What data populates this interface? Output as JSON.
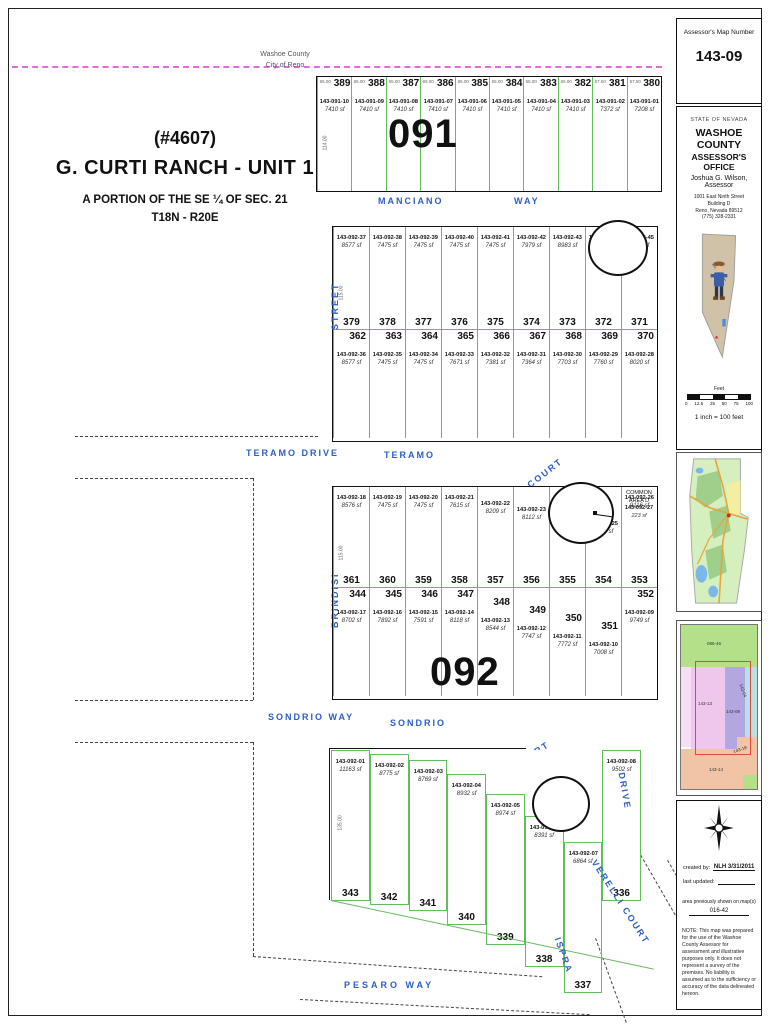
{
  "map": {
    "boundary": {
      "line1": "Washoe County",
      "line2": "City of Reno"
    },
    "title": {
      "permit": "(#4607)",
      "name": "G. CURTI RANCH - UNIT 1",
      "portion": "A PORTION OF THE SE ¼ OF SEC. 21",
      "township": "T18N - R20E"
    },
    "block_numbers": {
      "north": "091",
      "south": "092"
    },
    "streets": {
      "manciano": "MANCIANO",
      "manciano_suffix": "WAY",
      "teramo_drive": "TERAMO  DRIVE",
      "teramo": "TERAMO",
      "teramo_suffix": "COURT",
      "street_word": "STREET",
      "brindisi": "BRINDISI",
      "sondrio_way": "SONDRIO  WAY",
      "sondrio": "SONDRIO",
      "sondrio_suffix": "COURT",
      "pesaro": "PESARO   WAY",
      "verelli": "VERELLI  COURT",
      "ispra": "ISPRA",
      "drive": "DRIVE"
    },
    "common_area": {
      "line1": "COMMON",
      "line2": "AREA D",
      "apn": "143-092-27",
      "area": "223 sf"
    },
    "blocks": {
      "b091": {
        "side_dim": "114.00",
        "parcels": [
          {
            "lot": "389",
            "apn": "143-091-10",
            "area": "7410 sf",
            "dim": "65.00"
          },
          {
            "lot": "388",
            "apn": "143-091-09",
            "area": "7410 sf",
            "dim": "65.00"
          },
          {
            "lot": "387",
            "apn": "143-091-08",
            "area": "7410 sf",
            "dim": "65.00"
          },
          {
            "lot": "386",
            "apn": "143-091-07",
            "area": "7410 sf",
            "dim": "65.00"
          },
          {
            "lot": "385",
            "apn": "143-091-06",
            "area": "7410 sf",
            "dim": "65.00"
          },
          {
            "lot": "384",
            "apn": "143-091-05",
            "area": "7410 sf",
            "dim": "65.00"
          },
          {
            "lot": "383",
            "apn": "143-091-04",
            "area": "7410 sf",
            "dim": "65.00"
          },
          {
            "lot": "382",
            "apn": "143-091-03",
            "area": "7410 sf",
            "dim": "65.00"
          },
          {
            "lot": "381",
            "apn": "143-091-02",
            "area": "7372 sf",
            "dim": "67.50"
          },
          {
            "lot": "380",
            "apn": "143-091-01",
            "area": "7208 sf",
            "dim": "67.50"
          }
        ]
      },
      "b092a_top": {
        "side_dim": "115.00",
        "parcels": [
          {
            "lot": "379",
            "apn": "143-092-37",
            "area": "8577 sf"
          },
          {
            "lot": "378",
            "apn": "143-092-38",
            "area": "7475 sf"
          },
          {
            "lot": "377",
            "apn": "143-092-39",
            "area": "7475 sf"
          },
          {
            "lot": "376",
            "apn": "143-092-40",
            "area": "7475 sf"
          },
          {
            "lot": "375",
            "apn": "143-092-41",
            "area": "7475 sf"
          },
          {
            "lot": "374",
            "apn": "143-092-42",
            "area": "7979 sf"
          },
          {
            "lot": "373",
            "apn": "143-092-43",
            "area": "8983 sf"
          },
          {
            "lot": "372",
            "apn": "143-092-44",
            "area": "7107 sf"
          },
          {
            "lot": "371",
            "apn": "143-092-45",
            "area": "7067 sf"
          }
        ]
      },
      "b092a_bottom": {
        "side_dim": "115.00",
        "parcels": [
          {
            "lot": "362",
            "apn": "143-092-36",
            "area": "8577 sf"
          },
          {
            "lot": "363",
            "apn": "143-092-35",
            "area": "7475 sf"
          },
          {
            "lot": "364",
            "apn": "143-092-34",
            "area": "7475 sf"
          },
          {
            "lot": "365",
            "apn": "143-092-33",
            "area": "7671 sf"
          },
          {
            "lot": "366",
            "apn": "143-092-32",
            "area": "7381 sf"
          },
          {
            "lot": "367",
            "apn": "143-092-31",
            "area": "7364 sf"
          },
          {
            "lot": "368",
            "apn": "143-092-30",
            "area": "7703 sf"
          },
          {
            "lot": "369",
            "apn": "143-092-29",
            "area": "7760 sf"
          },
          {
            "lot": "370",
            "apn": "143-092-28",
            "area": "8020 sf"
          }
        ]
      },
      "b092b_top": {
        "side_dim": "115.00",
        "parcels": [
          {
            "lot": "361",
            "apn": "143-092-18",
            "area": "8576 sf"
          },
          {
            "lot": "360",
            "apn": "143-092-19",
            "area": "7475 sf"
          },
          {
            "lot": "359",
            "apn": "143-092-20",
            "area": "7475 sf"
          },
          {
            "lot": "358",
            "apn": "143-092-21",
            "area": "7615 sf"
          },
          {
            "lot": "357",
            "apn": "143-092-22",
            "area": "8209 sf"
          },
          {
            "lot": "356",
            "apn": "143-092-23",
            "area": "8112 sf"
          },
          {
            "lot": "355",
            "apn": "143-092-24",
            "area": "8225 sf"
          },
          {
            "lot": "354",
            "apn": "143-092-25",
            "area": "7050 sf"
          },
          {
            "lot": "353",
            "apn": "143-092-26",
            "area": "9116 sf"
          }
        ]
      },
      "b092b_bottom": {
        "side_dim": "135.00",
        "parcels": [
          {
            "lot": "344",
            "apn": "143-092-17",
            "area": "8702 sf"
          },
          {
            "lot": "345",
            "apn": "143-092-16",
            "area": "7892 sf"
          },
          {
            "lot": "346",
            "apn": "143-092-15",
            "area": "7591 sf"
          },
          {
            "lot": "347",
            "apn": "143-092-14",
            "area": "8118 sf"
          },
          {
            "lot": "348",
            "apn": "143-092-13",
            "area": "8544 sf"
          },
          {
            "lot": "349",
            "apn": "143-092-12",
            "area": "7747 sf"
          },
          {
            "lot": "350",
            "apn": "143-092-11",
            "area": "7772 sf"
          },
          {
            "lot": "351",
            "apn": "143-092-10",
            "area": "7008 sf"
          },
          {
            "lot": "352",
            "apn": "143-092-09",
            "area": "9749 sf"
          }
        ]
      },
      "b092c": {
        "side_dim": "135.00",
        "parcels": [
          {
            "lot": "343",
            "apn": "143-092-01",
            "area": "11163 sf"
          },
          {
            "lot": "342",
            "apn": "143-092-02",
            "area": "8775 sf"
          },
          {
            "lot": "341",
            "apn": "143-092-03",
            "area": "8769 sf"
          },
          {
            "lot": "340",
            "apn": "143-092-04",
            "area": "8932 sf"
          },
          {
            "lot": "339",
            "apn": "143-092-05",
            "area": "8974 sf"
          },
          {
            "lot": "338",
            "apn": "143-092-06",
            "area": "8391 sf"
          },
          {
            "lot": "337",
            "apn": "143-092-07",
            "area": "6864 sf"
          },
          {
            "lot": "336",
            "apn": "143-092-08",
            "area": "9502 sf"
          }
        ]
      }
    }
  },
  "sidebar": {
    "map_number_label": "Assessor's Map Number",
    "map_number": "143-09",
    "state": "STATE OF NEVADA",
    "county": "WASHOE COUNTY",
    "office": "ASSESSOR'S OFFICE",
    "assessor": "Joshua G. Wilson, Assessor",
    "address": [
      "1001 East Ninth Street",
      "Building D",
      "Reno, Nevada 89512",
      "(775) 328-2331"
    ],
    "scale_feet": "Feet",
    "scale_ticks": [
      "0",
      "12.5",
      "25",
      "50",
      "75",
      "100"
    ],
    "scale_note": "1 inch = 100 feet",
    "index": {
      "top": "086-46",
      "left": "143-13",
      "center": "143-09",
      "right": "143-04",
      "bottom_left": "143-14",
      "bottom_right": "143-18"
    },
    "created_by_label": "created by:",
    "created_by_value": "NLH 3/31/2011",
    "last_updated_label": "last updated:",
    "prev_maps_label": "area previously shown on map(s)",
    "prev_maps_value": "016-42",
    "note": "NOTE:  This map was prepared for the use of the Washoe County Assessor for assessment and illustrative purposes only.  It does not represent a survey of the premises.  No liability is assumed as to the sufficiency or accuracy of the data delineated hereon."
  }
}
